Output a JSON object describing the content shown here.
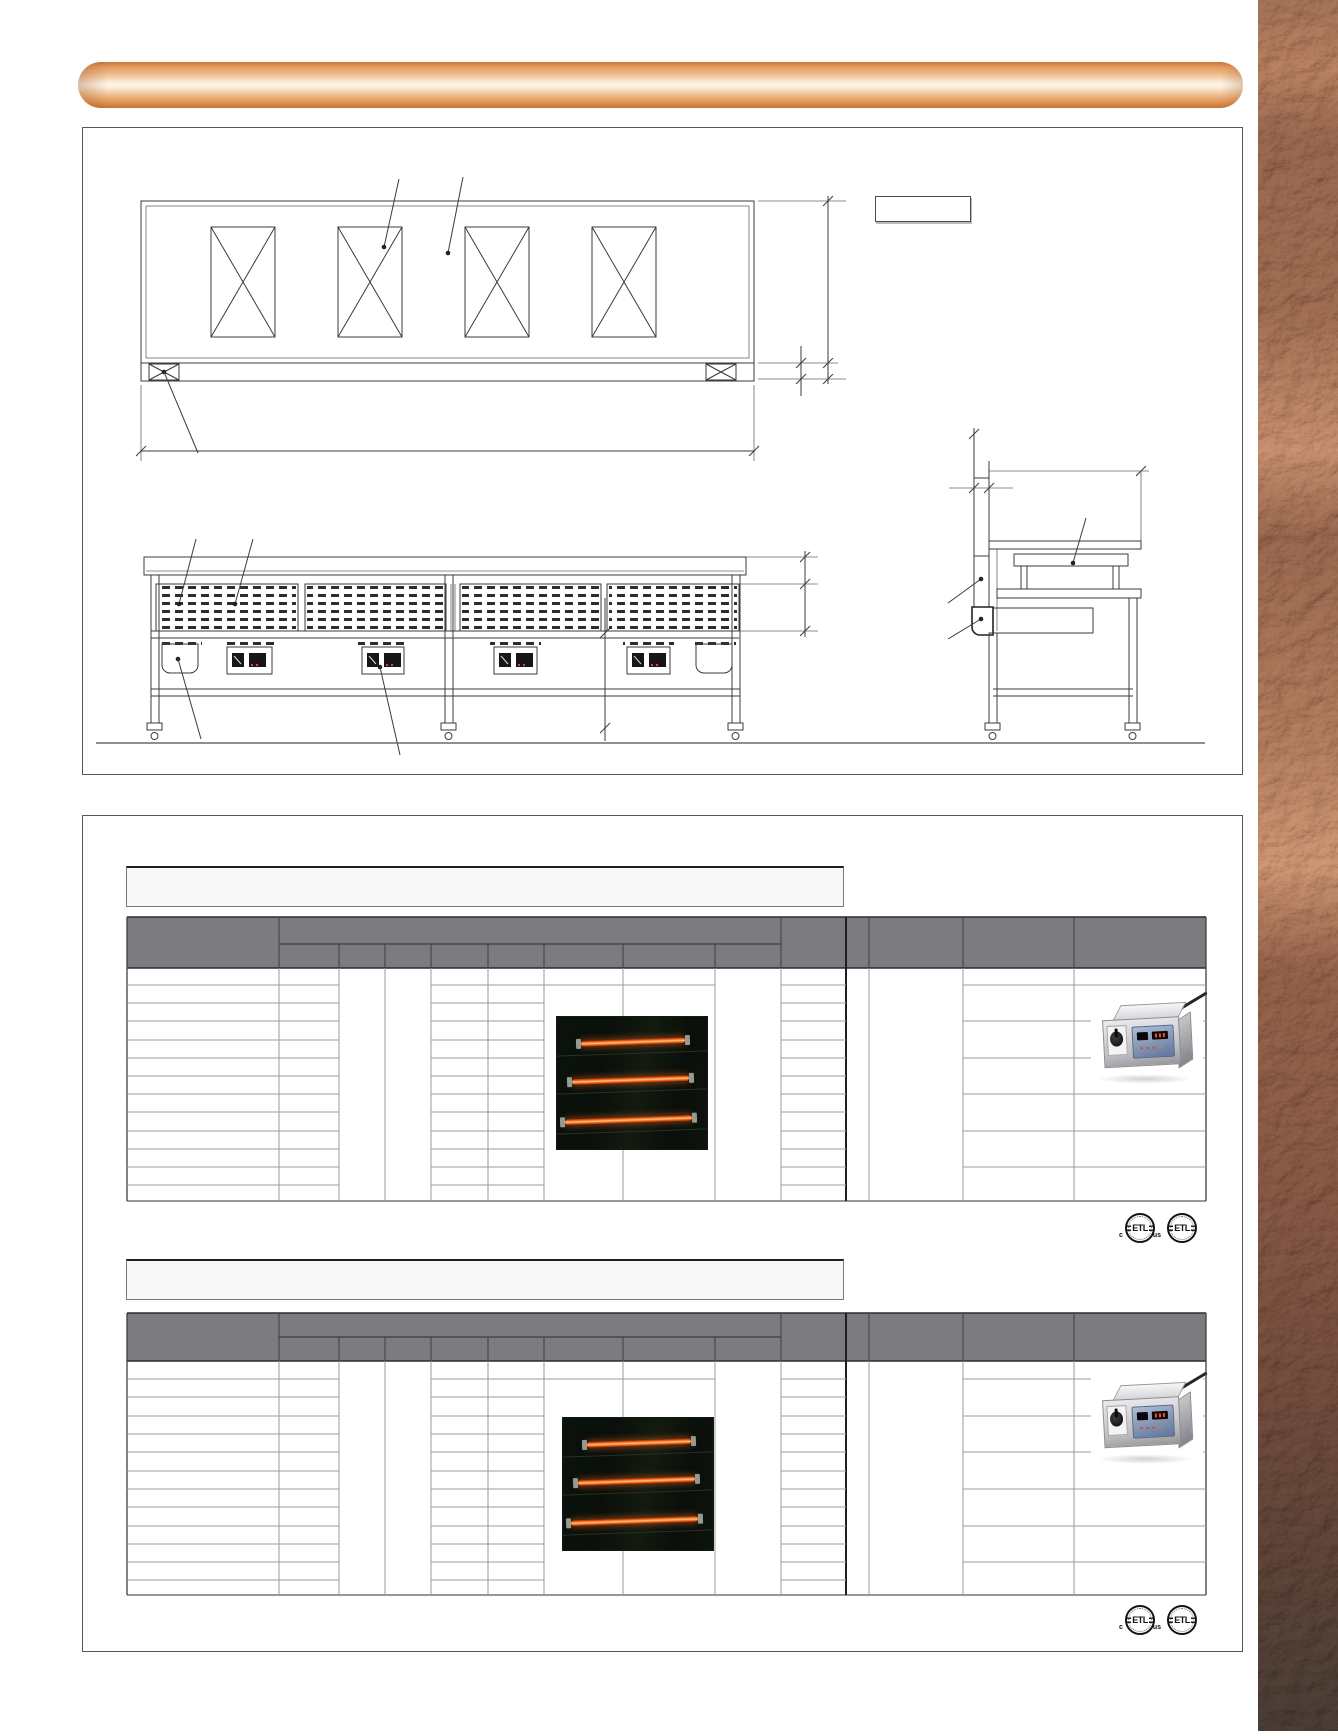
{
  "banner": {
    "text": ""
  },
  "drawing_panel": {
    "views": [
      "plan-view",
      "front-elevation-view",
      "side-section-view"
    ],
    "label_box_text": ""
  },
  "spec_tables": [
    {
      "title": "",
      "header_text": "",
      "cells_empty": true
    },
    {
      "title": "",
      "header_text": "",
      "cells_empty": true
    }
  ],
  "etl": {
    "letters": "ETL",
    "c": "c",
    "us": "us"
  },
  "colors": {
    "banner_copper": "#e08f52",
    "table_header_gray": "#7c7c80",
    "heater_tube_orange": "#ff6a1f",
    "texture_copper_brown": "#8a5a44",
    "drawing_line": "#3b3b3d"
  }
}
